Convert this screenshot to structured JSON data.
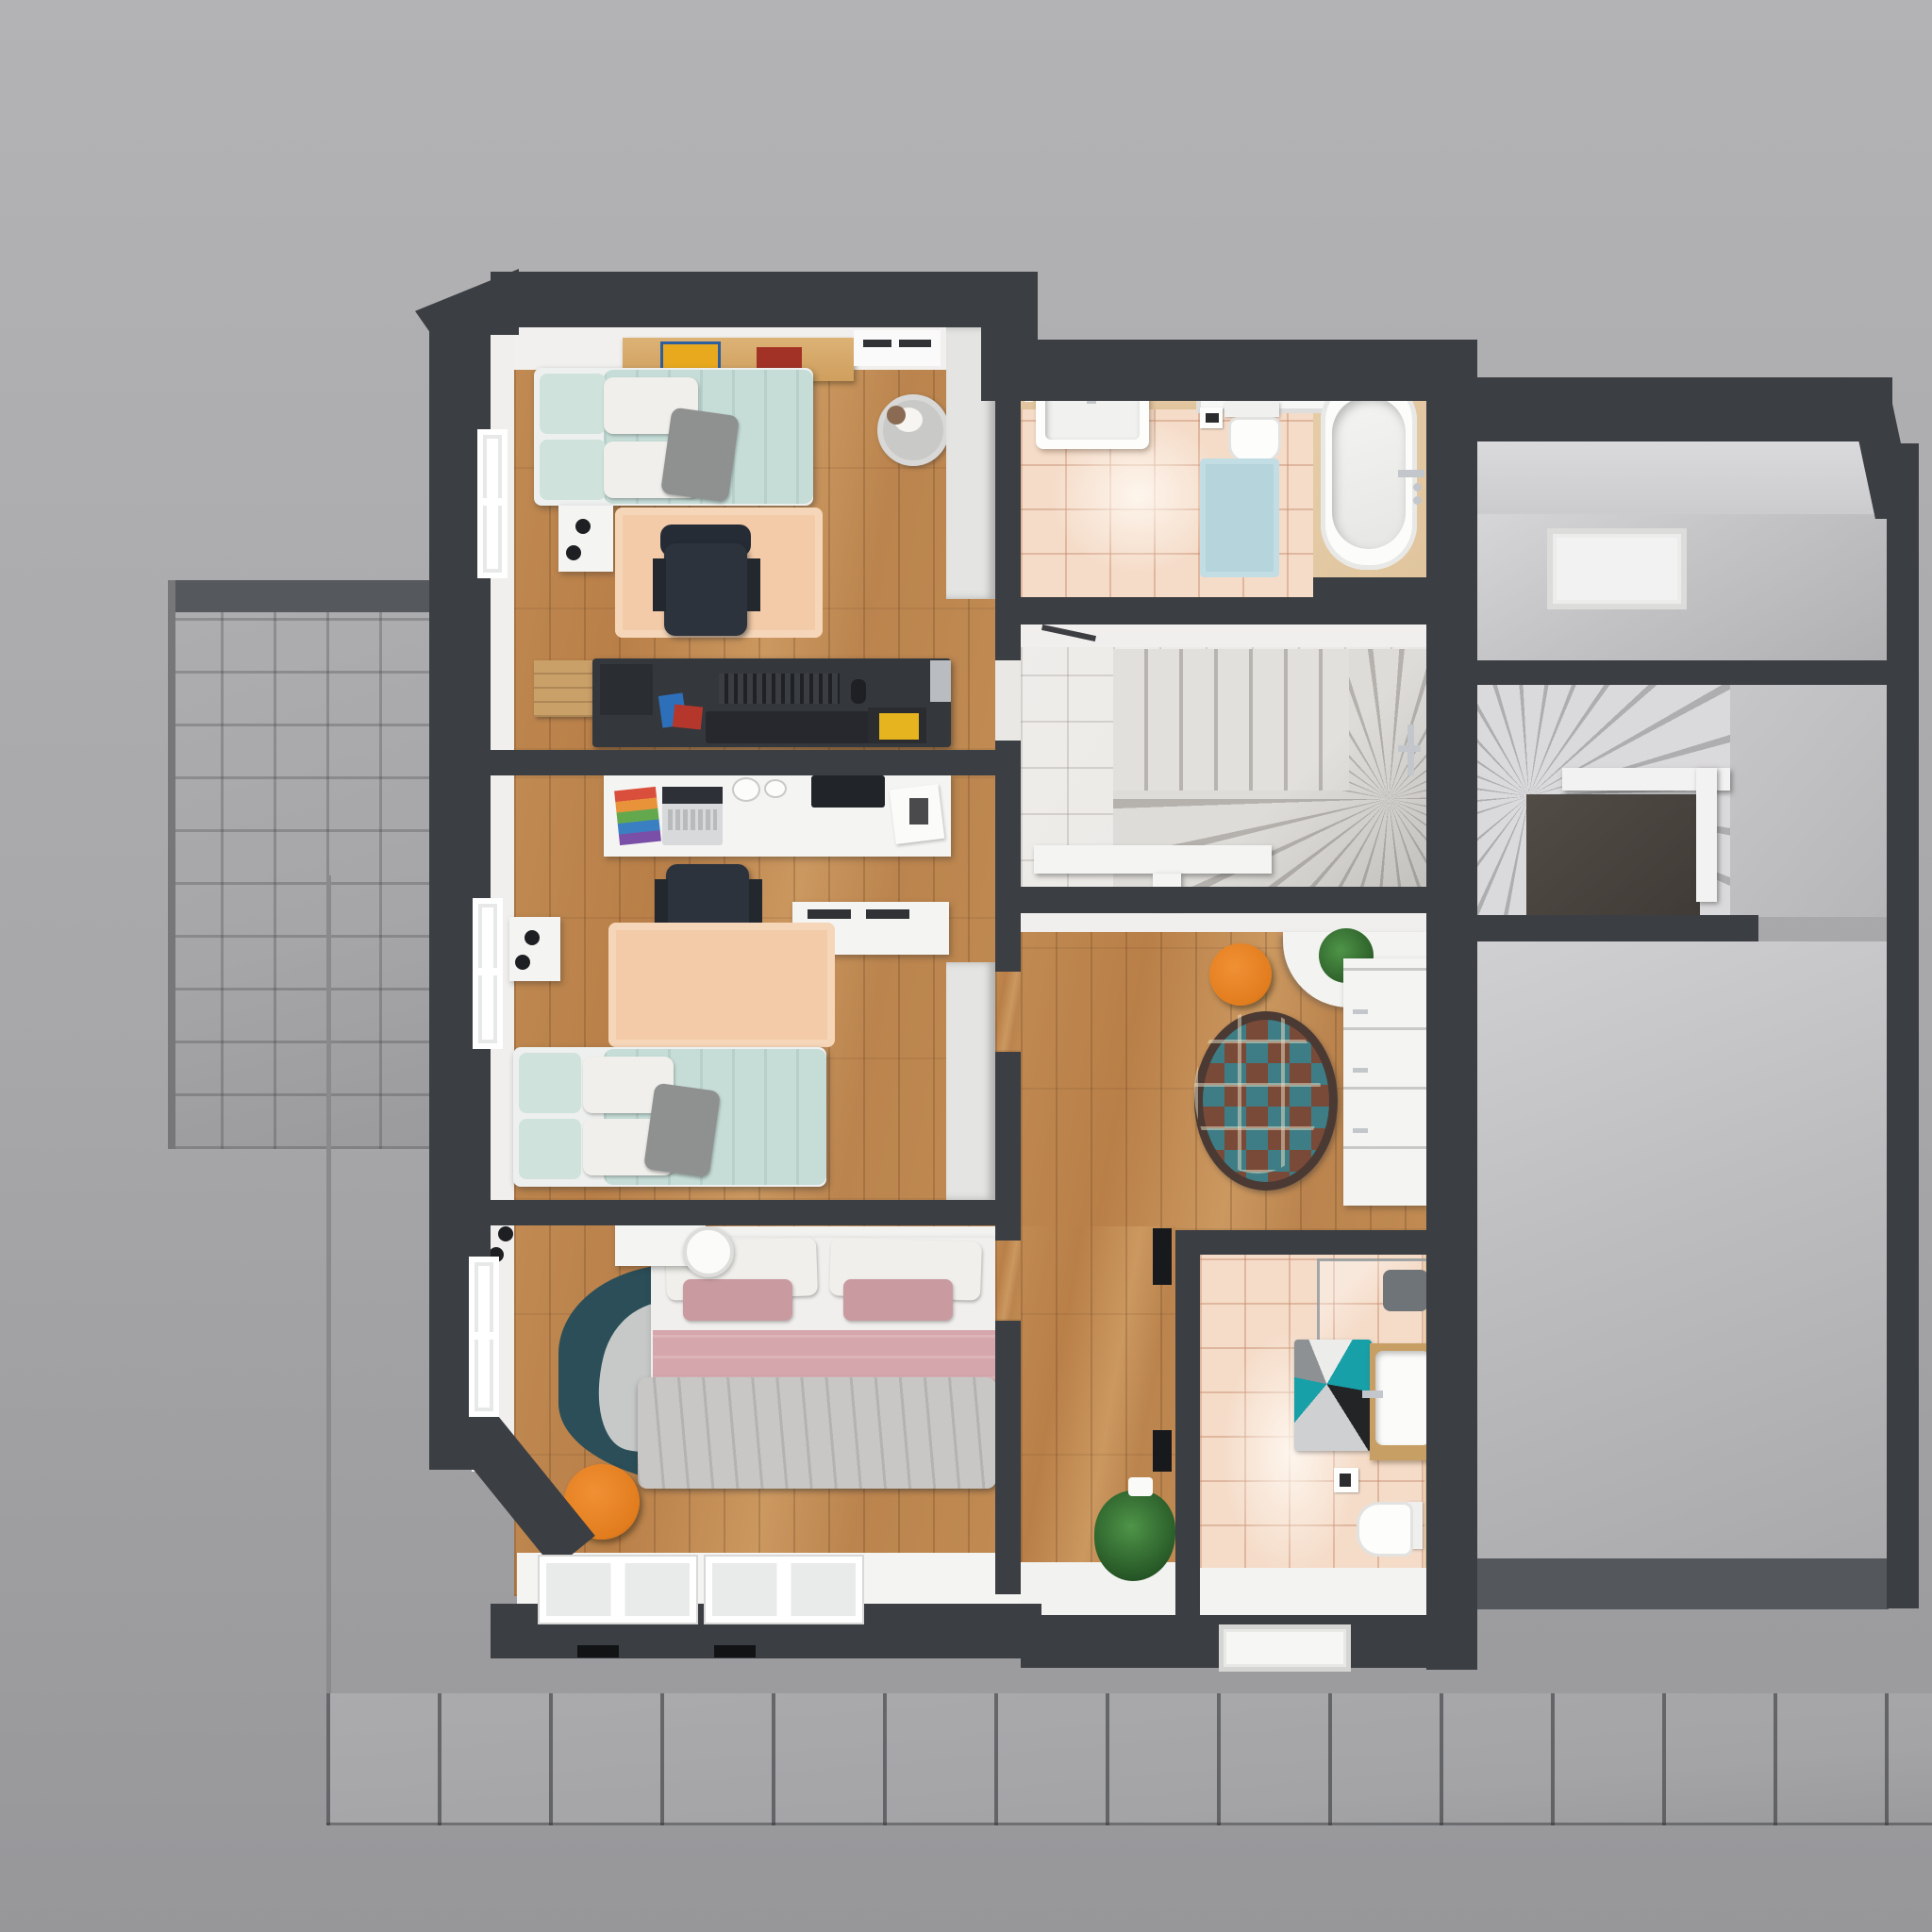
{
  "scene": {
    "title": "Top-down 3D cutaway render of an upper-storey floor plan",
    "view": "orthographic top view, no visible text labels",
    "style": "photoreal architectural visualization"
  },
  "palette": {
    "bg_top": "#b3b3b5",
    "bg_bottom": "#97979a",
    "wall": "#3b3e42",
    "inner_face": "#f0efed",
    "wood": "#c08a52",
    "tile_peach": "#f5dcc9",
    "marble": "#ebe9e6",
    "balcony": "#a6a6a8",
    "walkway": "#a4a4a6",
    "furn_white": "#f4f4f2",
    "bed_teal": "#c6ddd7",
    "bed_pink": "#d5a6ab",
    "rug_peach": "#f3cba8",
    "rug_dark_teal": "#2b4e58",
    "rug_blue": "#b5d4dc",
    "accent_orange": "#e27d1e",
    "desk_dark": "#34373c",
    "tub_deck": "#e0c59e"
  },
  "rooms": [
    {
      "id": "bedroom-top",
      "name": "kids bedroom 1",
      "floor": "oak plank",
      "furniture": [
        "single bed teal bedding",
        "wall shelf with books",
        "nightstand with black lamp",
        "peach rug",
        "dark gaming desk with monitor",
        "office chair",
        "wooden crate",
        "laundry basket",
        "wardrobe",
        "window"
      ]
    },
    {
      "id": "bedroom-middle",
      "name": "kids bedroom 2",
      "floor": "oak plank",
      "furniture": [
        "white desk with laptop and rainbow notebook",
        "office chair",
        "white sideboard with vents",
        "peach rug",
        "single bed teal bedding",
        "nightstand with black lamp",
        "wardrobe",
        "window"
      ]
    },
    {
      "id": "bedroom-bottom",
      "name": "master bedroom",
      "floor": "oak plank",
      "furniture": [
        "double bed pink and white bedding with gray blanket",
        "floating shelf with round lamp",
        "dark teal wavy rug",
        "orange pouf",
        "bay window with two panes",
        "window"
      ]
    },
    {
      "id": "bathroom-top",
      "name": "family bathroom",
      "floor": "peach ceramic tile",
      "furniture": [
        "vanity sink",
        "wall niche",
        "toilet with paper holder",
        "light blue bath mat",
        "bathtub in wooden deck with chrome fittings"
      ]
    },
    {
      "id": "stair-room",
      "name": "staircase room",
      "floor": "white marble tile",
      "furniture": [
        "winder staircase",
        "white railing",
        "door with chrome handle"
      ]
    },
    {
      "id": "hallway",
      "name": "landing hallway",
      "floor": "oak plank",
      "furniture": [
        "orange pouf",
        "round patchwork rug",
        "white dresser",
        "potted plants",
        "picture frames"
      ]
    },
    {
      "id": "bathroom-bottom",
      "name": "shower bathroom",
      "floor": "peach ceramic tile",
      "furniture": [
        "glass shower enclosure",
        "geometric teal bath rug",
        "wooden vanity with sink",
        "toilet",
        "toilet paper holder",
        "window"
      ]
    },
    {
      "id": "attic-top",
      "name": "unfinished attic room",
      "floor": "bare gray screed",
      "furniture": [
        "skylight opening"
      ]
    },
    {
      "id": "attic-stairs",
      "name": "attic spiral stair",
      "floor": "bare gray screed",
      "furniture": [
        "spiral winder stairs",
        "white railing",
        "stairwell void"
      ]
    },
    {
      "id": "attic-bottom",
      "name": "unfinished attic storage",
      "floor": "bare gray screed",
      "furniture": []
    },
    {
      "id": "balcony",
      "name": "tiled balcony",
      "floor": "gray stone tile",
      "furniture": []
    },
    {
      "id": "walkway",
      "name": "ground walkway",
      "floor": "large gray pavers",
      "furniture": []
    }
  ]
}
